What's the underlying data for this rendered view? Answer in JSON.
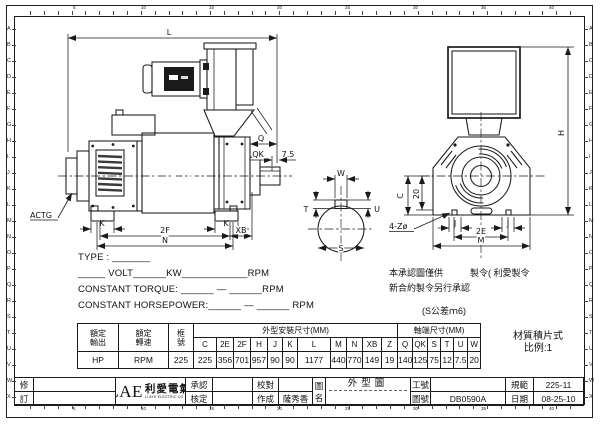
{
  "border": {
    "top_numbers": [
      "5",
      "10",
      "15",
      "20",
      "25",
      "30",
      "35",
      "40"
    ],
    "bottom_numbers": [
      "5",
      "10",
      "15",
      "20",
      "25",
      "30",
      "35",
      "40"
    ],
    "left_letters": [
      "A",
      "B",
      "C",
      "D",
      "E",
      "F",
      "G",
      "H",
      "I",
      "J",
      "K",
      "L",
      "M",
      "N",
      "O",
      "P",
      "Q",
      "R",
      "S",
      "T",
      "U",
      "V",
      "W",
      "X"
    ],
    "right_letters": [
      "A",
      "B",
      "C",
      "D",
      "E",
      "F",
      "G",
      "H",
      "I",
      "J",
      "K",
      "L",
      "M",
      "N",
      "O",
      "P",
      "Q",
      "R",
      "S",
      "T",
      "U",
      "V",
      "W",
      "X"
    ]
  },
  "drawing": {
    "labels": {
      "l": "L",
      "q": "Q",
      "qk": "QK",
      "k75": "7.5",
      "actg": "ACTG",
      "k": "K",
      "f2": "2F",
      "n": "N",
      "xb": "XB",
      "w": "W",
      "t": "T",
      "u": "U",
      "s": "S",
      "c": "C",
      "d20": "20",
      "z4": "4-Zø",
      "j": "J",
      "e2": "2E",
      "m": "M",
      "h": "H"
    }
  },
  "specs": {
    "lines": [
      "TYPE : _______",
      "_____ VOLT______KW____________RPM",
      "CONSTANT TORQUE: ______ — ______RPM",
      "CONSTANT HORSEPOWER:______ — ______ RPM"
    ]
  },
  "notes": {
    "approval_line1": "本承認圖僅供　　　製令( 利愛製令",
    "approval_line2": "新合約製令另行承認",
    "tolerance": "(S公差ｍ6)",
    "material": "材質積片式",
    "scale": "比例:1"
  },
  "dim_table": {
    "rated_output_label": "額定\n輸出",
    "rated_output_value": "HP",
    "rated_speed_label": "額定\n轉速",
    "rated_speed_value": "RPM",
    "frame_label": "框\n號",
    "frame_value": "225",
    "outline_group": "外型安裝尺寸(MM)",
    "outline_cols": [
      "C",
      "2E",
      "2F",
      "H",
      "J",
      "K",
      "L",
      "M",
      "N",
      "XB",
      "Z"
    ],
    "outline_vals": [
      "225",
      "356",
      "701",
      "957",
      "90",
      "90",
      "1177",
      "440",
      "770",
      "149",
      "19"
    ],
    "shaft_group": "軸端尺寸(MM)",
    "shaft_cols": [
      "Q",
      "QK",
      "S",
      "T",
      "U",
      "W"
    ],
    "shaft_vals": [
      "140",
      "125",
      "75",
      "12",
      "7.5",
      "20"
    ]
  },
  "title_block": {
    "revision_top": "修",
    "revision_bottom": "訂",
    "logo": {
      "lae": "LAE",
      "cn": "利愛電氣",
      "sub": "LI AYE ELECTRIC CO.,LTD"
    },
    "approve_label": "承認",
    "check_label": "核定",
    "proof_label": "校對",
    "made_label": "作成",
    "made_value": "薩秀香",
    "dwg_name_label": "圖\n名",
    "dwg_name_value": "外型圖",
    "work_no_label": "工號",
    "work_no_value": "",
    "dwg_no_label": "圖號",
    "dwg_no_value": "DB0590A",
    "spec_label": "規範",
    "spec_value": "225-11",
    "date_label": "日期",
    "date_value": "08-25-10"
  }
}
